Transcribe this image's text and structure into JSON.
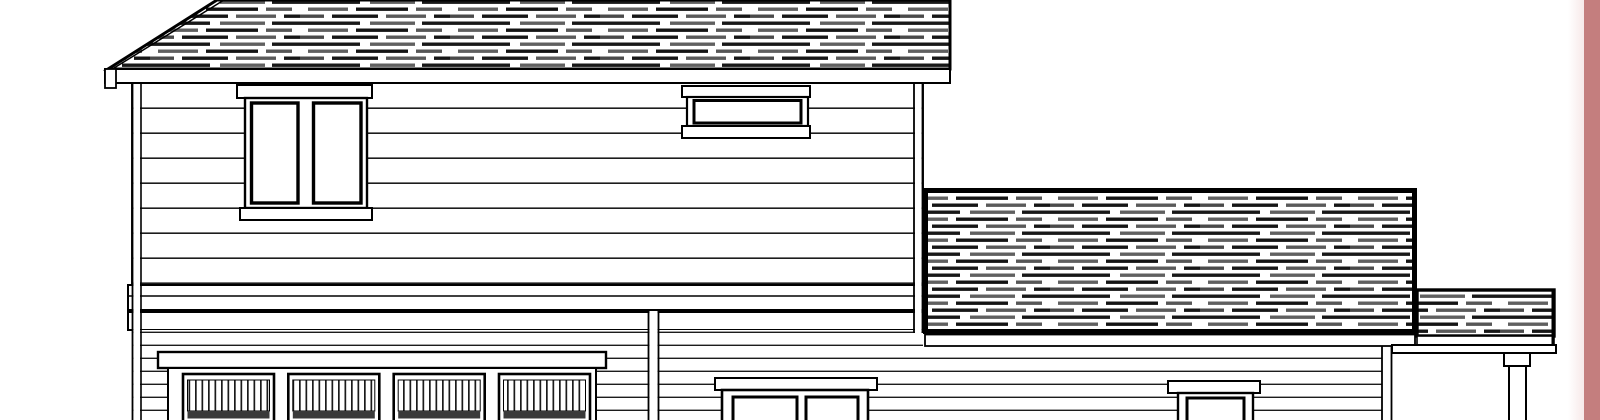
{
  "meta": {
    "kind": "architectural-elevation-line-drawing",
    "subject": "two-story house with attached garage, lower side wing and porch",
    "visible_text": ""
  },
  "colors": {
    "background": "#ffffff",
    "linework": "#000000",
    "shingle_dark": "#1a1a1a",
    "shingle_mid": "#5e5e5e",
    "siding_line": "#1c1c1c",
    "accent_stripe": "#c47e7e",
    "accent_stripe_fade": "#f7e9e9"
  },
  "scene": {
    "roof_sections": 3,
    "windows_visible": 4,
    "garage_door_panels": 4,
    "slats_per_panel": 13,
    "porch_posts": 2
  }
}
